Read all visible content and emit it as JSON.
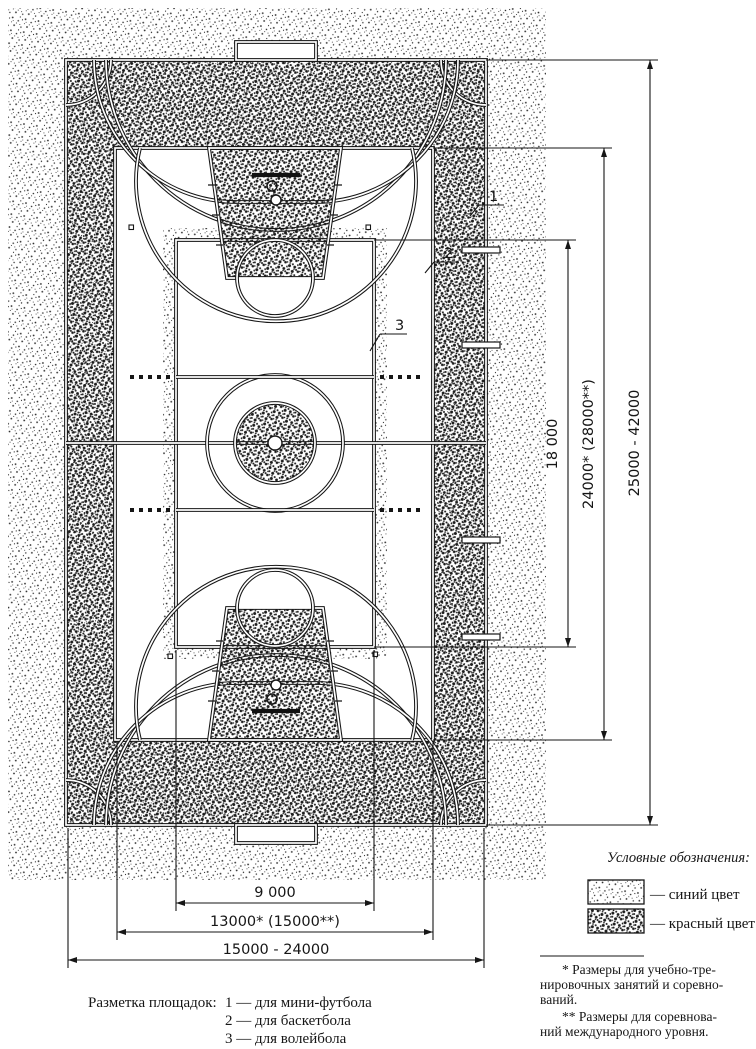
{
  "page": {
    "background": "#ffffff",
    "ink": "#161616"
  },
  "diagram": {
    "callouts": {
      "c1": "1",
      "c2": "2",
      "c3": "3"
    },
    "dims": {
      "v18": "18 000",
      "v24": "24000* (28000**)",
      "v25": "25000 - 42000",
      "h9": "9 000",
      "h13": "13000* (15000**)",
      "h15": "15000 - 24000"
    },
    "legend": {
      "title": "Условные обозначения:",
      "blue_label": "— синий цвет",
      "red_label": "— красный цвет"
    },
    "footnotes": {
      "l1": "* Размеры для учебно-тре-",
      "l2": "нировочных занятий и соревно-",
      "l3": "ваний.",
      "l4": "** Размеры для соревнова-",
      "l5": "ний международного уровня."
    },
    "caption": {
      "intro": "Разметка площадок:",
      "item1": "1 — для мини-футбола",
      "item2": "2 — для баскетбола",
      "item3": "3 — для волейбола"
    }
  }
}
